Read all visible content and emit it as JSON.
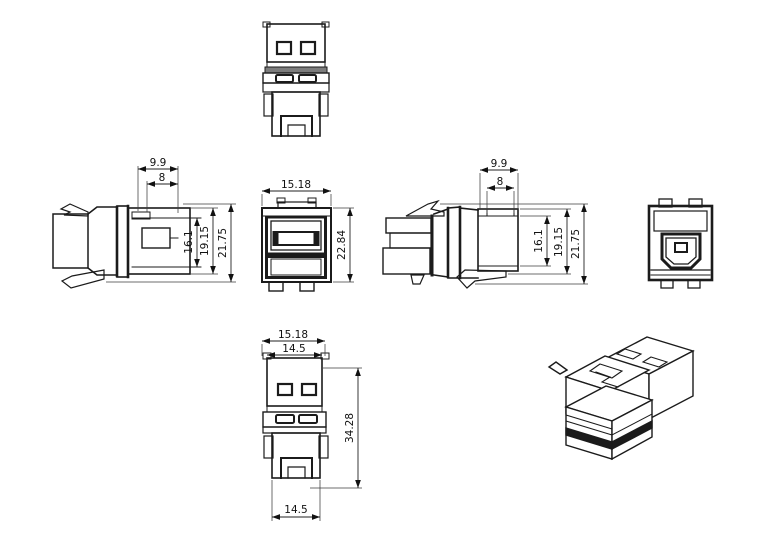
{
  "page": {
    "background": "#ffffff"
  },
  "drawing": {
    "type": "technical-multiview-drawing",
    "colors": {
      "line": "#1b1b1b",
      "gray_band": "#7c7c7c",
      "dark_stripe": "#1b1b1b",
      "background": "#ffffff"
    },
    "dims": {
      "side_left": {
        "step_outer": "9.9",
        "step_inner": "8",
        "cavity_height": "16.1",
        "body_height": "19.15",
        "overall_height": "21.75"
      },
      "side_right": {
        "step_outer": "9.9",
        "step_inner": "8",
        "cavity_height": "16.1",
        "body_height": "19.15",
        "overall_height": "21.75"
      },
      "front": {
        "overall_width": "15.18",
        "overall_height": "22.84"
      },
      "plan": {
        "overall_width": "15.18",
        "usb_width": "14.5",
        "overall_length": "34.28",
        "rear_width": "14.5"
      }
    }
  }
}
